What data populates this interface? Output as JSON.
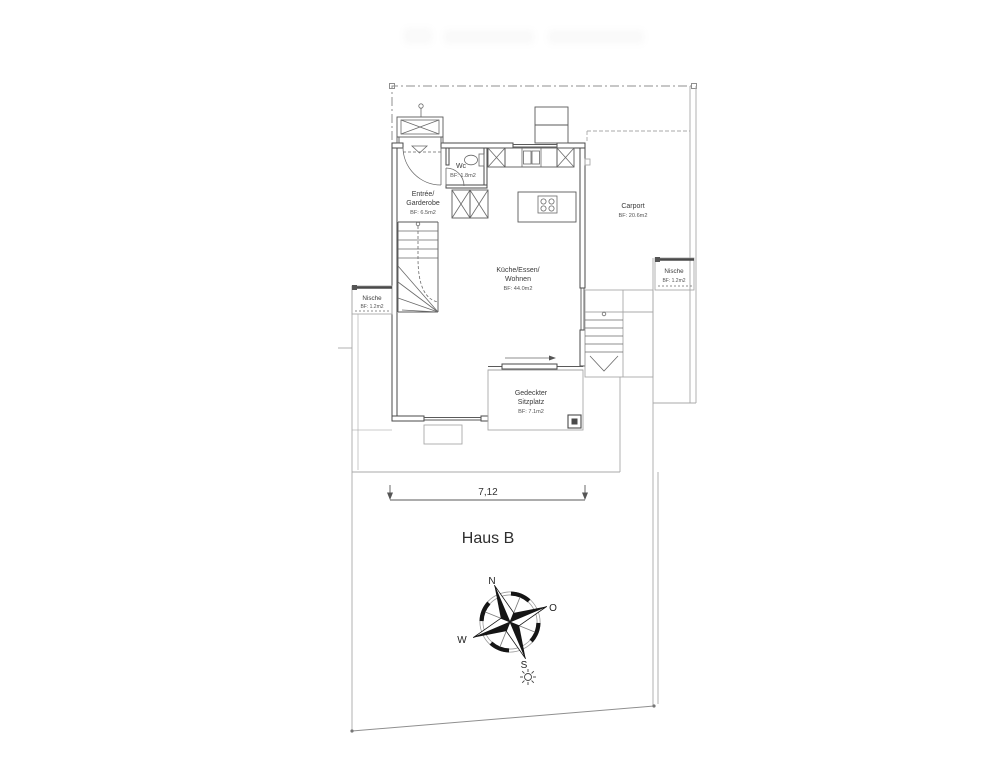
{
  "title": {
    "label": "Haus B"
  },
  "dimension": {
    "label": "7,12"
  },
  "rooms": {
    "wc": {
      "name": "Wc",
      "area": "BF: 1.8m2"
    },
    "entree": {
      "line1": "Entrée/",
      "line2": "Garderobe",
      "area": "BF: 6.5m2"
    },
    "kueche": {
      "line1": "Küche/Essen/",
      "line2": "Wohnen",
      "area": "BF: 44.0m2"
    },
    "carport": {
      "name": "Carport",
      "area": "BF: 20.6m2"
    },
    "nische_left": {
      "name": "Nische",
      "area": "BF: 1.2m2"
    },
    "nische_right": {
      "name": "Nische",
      "area": "BF: 1.2m2"
    },
    "sitzplatz": {
      "line1": "Gedeckter",
      "line2": "Sitzplatz",
      "area": "BF: 7.1m2"
    }
  },
  "compass": {
    "north": "N",
    "east": "O",
    "south": "S",
    "west": "W"
  },
  "colors": {
    "wall": "#4a4a4a",
    "thin_line": "#5a5a5a",
    "light_line": "#a9a9a9",
    "text": "#3a3a3a"
  }
}
